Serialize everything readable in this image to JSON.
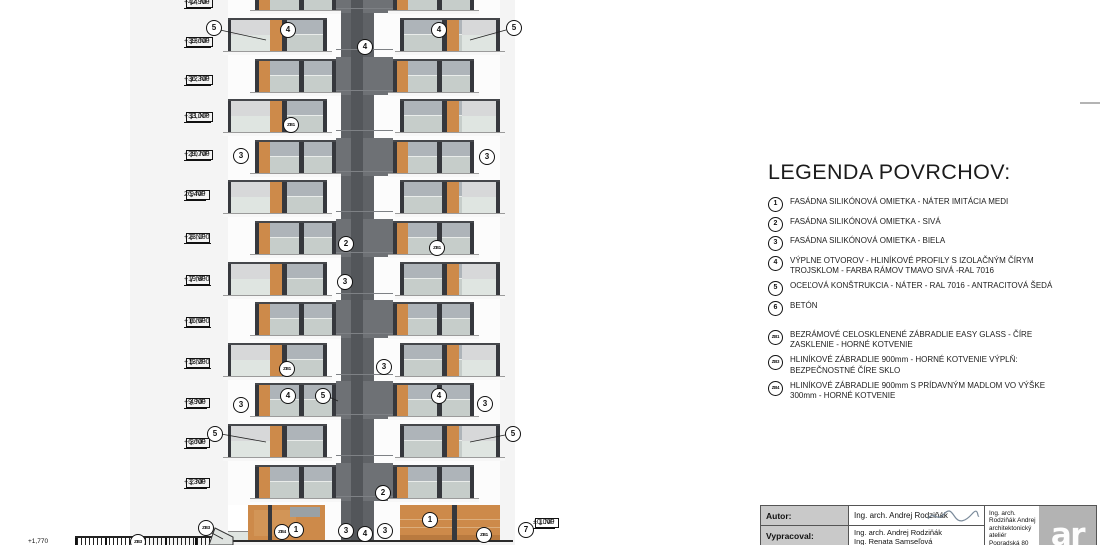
{
  "legend": {
    "title": "LEGENDA POVRCHOV:",
    "items": [
      {
        "tag": "1",
        "zb": false,
        "gap": false,
        "text": "FASÁDNA SILIKÓNOVÁ OMIETKA - NÁTER IMITÁCIA MEDI"
      },
      {
        "tag": "2",
        "zb": false,
        "gap": false,
        "text": "FASÁDNA SILIKÓNOVÁ OMIETKA - SIVÁ"
      },
      {
        "tag": "3",
        "zb": false,
        "gap": false,
        "text": "FASÁDNA SILIKÓNOVÁ OMIETKA - BIELA"
      },
      {
        "tag": "4",
        "zb": false,
        "gap": false,
        "text": "VÝPLNE OTVOROV - HLINÍKOVÉ PROFILY S  IZOLAČNÝM ČÍRYM TROJSKLOM - FARBA RÁMOV TMAVO SIVÁ -RAL 7016"
      },
      {
        "tag": "5",
        "zb": false,
        "gap": false,
        "text": "OCEĽOVÁ KONŠTRUKCIA - NÁTER -  RAL 7016 - ANTRACITOVÁ ŠEDÁ"
      },
      {
        "tag": "6",
        "zb": false,
        "gap": false,
        "text": "BETÓN"
      },
      {
        "tag": "ZB1",
        "zb": true,
        "gap": true,
        "text": "BEZRÁMOVÉ CELOSKLENENÉ ZÁBRADLIE EASY GLASS - ČÍRE ZASKLENIE - HORNÉ KOTVENIE"
      },
      {
        "tag": "ZB3",
        "zb": true,
        "gap": false,
        "text": "HLINÍKOVÉ ZÁBRADLIE  900mm - HORNÉ KOTVENIE VÝPLŇ: BEZPEČNOSTNÉ ČÍRE SKLO"
      },
      {
        "tag": "ZB4",
        "zb": true,
        "gap": false,
        "text": "HLINÍKOVÉ ZÁBRADLIE 900mm S PRÍDAVNÝM MADLOM VO VÝŠKE 300mm - HORNÉ KOTVENIE"
      }
    ]
  },
  "levels": [
    {
      "value": "+42,900",
      "floor": "14.NP",
      "y": 8,
      "side": "left"
    },
    {
      "value": "+39,600",
      "floor": "13.NP",
      "y": 47,
      "side": "left"
    },
    {
      "value": "+36,300",
      "floor": "12.NP",
      "y": 85,
      "side": "left"
    },
    {
      "value": "+33,000",
      "floor": "11.NP",
      "y": 122,
      "side": "left"
    },
    {
      "value": "+29,700",
      "floor": "10.NP",
      "y": 160,
      "side": "left"
    },
    {
      "value": "26,400",
      "floor": "9.NP",
      "y": 200,
      "side": "left"
    },
    {
      "value": "+23,100",
      "floor": "8.NP",
      "y": 243,
      "side": "left"
    },
    {
      "value": "+19,800",
      "floor": "7.NP",
      "y": 285,
      "side": "left"
    },
    {
      "value": "+16,500",
      "floor": "6.NP",
      "y": 327,
      "side": "left"
    },
    {
      "value": "+13,200",
      "floor": "5.NP",
      "y": 368,
      "side": "left"
    },
    {
      "value": "+9,900",
      "floor": "4.NP",
      "y": 408,
      "side": "left"
    },
    {
      "value": "+6,600",
      "floor": "3.NP",
      "y": 448,
      "side": "left"
    },
    {
      "value": "+3,300",
      "floor": "2.NP",
      "y": 488,
      "side": "left"
    },
    {
      "value": "±0,000",
      "floor": "1.NP",
      "y": 528,
      "side": "right"
    }
  ],
  "markers": [
    {
      "label": "5",
      "x": 213,
      "y": 27
    },
    {
      "label": "4",
      "x": 287,
      "y": 29
    },
    {
      "label": "4",
      "x": 364,
      "y": 46
    },
    {
      "label": "4",
      "x": 438,
      "y": 29
    },
    {
      "label": "5",
      "x": 513,
      "y": 27
    },
    {
      "label": "ZB1",
      "x": 290,
      "y": 124
    },
    {
      "label": "3",
      "x": 240,
      "y": 155
    },
    {
      "label": "3",
      "x": 486,
      "y": 156
    },
    {
      "label": "2",
      "x": 345,
      "y": 243
    },
    {
      "label": "ZB1",
      "x": 436,
      "y": 247
    },
    {
      "label": "3",
      "x": 344,
      "y": 281
    },
    {
      "label": "ZB1",
      "x": 286,
      "y": 368
    },
    {
      "label": "3",
      "x": 383,
      "y": 366
    },
    {
      "label": "3",
      "x": 240,
      "y": 404
    },
    {
      "label": "4",
      "x": 287,
      "y": 395
    },
    {
      "label": "5",
      "x": 322,
      "y": 395
    },
    {
      "label": "4",
      "x": 438,
      "y": 395
    },
    {
      "label": "3",
      "x": 484,
      "y": 403
    },
    {
      "label": "5",
      "x": 214,
      "y": 433
    },
    {
      "label": "5",
      "x": 512,
      "y": 433
    },
    {
      "label": "2",
      "x": 382,
      "y": 492
    },
    {
      "label": "ZB3",
      "x": 205,
      "y": 527
    },
    {
      "label": "ZB4",
      "x": 281,
      "y": 531
    },
    {
      "label": "1",
      "x": 295,
      "y": 529
    },
    {
      "label": "3",
      "x": 345,
      "y": 530
    },
    {
      "label": "4",
      "x": 364,
      "y": 533
    },
    {
      "label": "3",
      "x": 384,
      "y": 530
    },
    {
      "label": "1",
      "x": 429,
      "y": 519
    },
    {
      "label": "ZB1",
      "x": 483,
      "y": 534
    },
    {
      "label": "7",
      "x": 525,
      "y": 529
    },
    {
      "label": "ZB3",
      "x": 137,
      "y": 541
    }
  ],
  "leaders": [
    [
      220,
      30,
      266,
      40
    ],
    [
      506,
      30,
      470,
      40
    ],
    [
      329,
      397,
      338,
      401
    ],
    [
      221,
      434,
      266,
      442
    ],
    [
      505,
      435,
      470,
      442
    ],
    [
      210,
      532,
      223,
      539
    ]
  ],
  "annotations": {
    "ground_note": "+1,770"
  },
  "titleblock": {
    "autor_label": "Autor:",
    "autor_name": "Ing. arch. Andrej Rodziňák",
    "vypracoval_label": "Vypracoval:",
    "vypracoval_names": [
      "Ing. arch. Andrej Rodziňák",
      "Ing. Renata Samseľová"
    ],
    "office": [
      "Ing. arch.",
      "Rodziňák Andrej",
      "architektonický ateliér",
      "Popradská 80"
    ],
    "logo": "ar"
  },
  "building": {
    "floors_top": 14,
    "colors": {
      "backdrop": "#f4f4f4",
      "wall_bg": "#fcfcfc",
      "glass_hi": "#aeb4b9",
      "glass_lo": "#c6cdca",
      "rail_glass": "#dfe5e1",
      "side_wall": "#d7d8d9",
      "timber": "#cd8a4a",
      "timber_dark": "#b97a3f",
      "timber_light": "#d29557",
      "frame": "#36383d",
      "core_base": "#5f6266",
      "core_wide": "#6e7175",
      "core_center": "#53565a",
      "slab": "#f7f7f7",
      "ground_line": "#2b2b2b",
      "fence": "#222222",
      "ramp": "#dfe3e0"
    }
  }
}
